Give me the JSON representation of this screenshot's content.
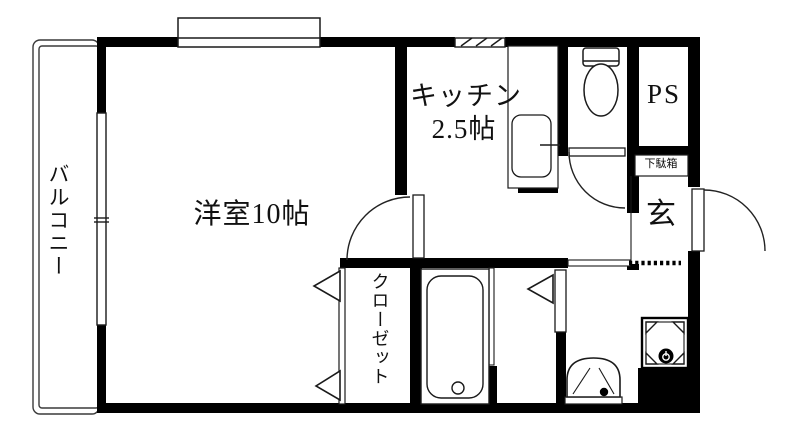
{
  "plan": {
    "type": "floor-plan",
    "colors": {
      "wall": "#000000",
      "line": "#1a1a1a",
      "background": "#ffffff"
    },
    "rooms": {
      "living": {
        "label": "洋室10帖"
      },
      "kitchen": {
        "label_line1": "キッチン",
        "label_line2": "2.5帖"
      },
      "balcony": {
        "label": "バルコニー"
      },
      "closet": {
        "label": "クローゼット"
      },
      "pipe_space": {
        "label": "PS"
      },
      "entrance": {
        "label": "玄"
      },
      "shoe_cabinet": {
        "label": "下駄箱"
      }
    },
    "fixtures": {
      "bathtub": "bathtub-icon",
      "toilet": "toilet-icon",
      "kitchen_sink": "kitchen-sink-icon",
      "wash_basin": "wash-basin-icon",
      "washing_machine_pan": "washing-machine-pan-icon",
      "entry_door": "swing-door-icon",
      "toilet_door": "swing-door-icon",
      "room_door": "swing-door-icon",
      "bath_folding_door": "folding-door-icon",
      "closet_folding_doors": "folding-door-icon",
      "windows": "window-icon",
      "entry_step": "dashed-step-line"
    }
  }
}
